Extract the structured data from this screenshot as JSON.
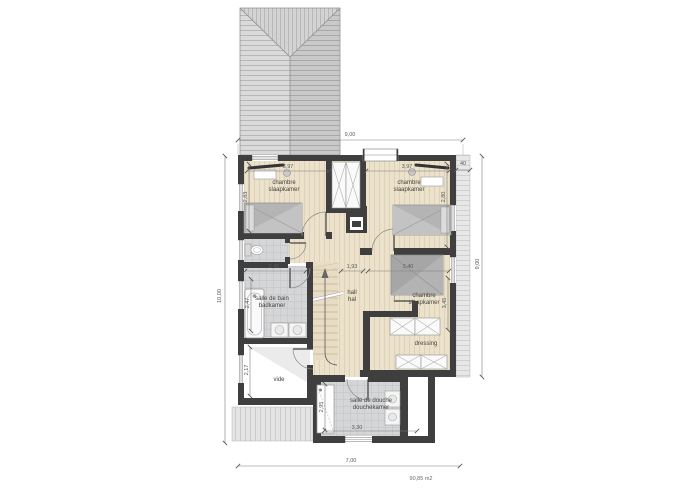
{
  "drawing": {
    "type": "floor-plan",
    "area_label": "90,85 m2"
  },
  "rooms": {
    "bedroom_top_left": {
      "line1": "chambre",
      "line2": "slaapkamer"
    },
    "bedroom_top_right": {
      "line1": "chambre",
      "line2": "slaapkamer"
    },
    "bedroom_right": {
      "line1": "chambre",
      "line2": "slaapkamer"
    },
    "bathroom": {
      "line1": "salle de bain",
      "line2": "badkamer"
    },
    "hall": {
      "line1": "hall",
      "line2": "hal"
    },
    "void": {
      "line1": "vide"
    },
    "dressing": {
      "line1": "dressing"
    },
    "shower_room": {
      "line1": "salle de douche",
      "line2": "douchekamer"
    }
  },
  "dimensions": {
    "overall_top": "9,00",
    "overall_bottom": "7,00",
    "overall_left": "10,00",
    "overall_right": "9,00",
    "eave_offset": "40",
    "bedroom_tl_width": "3,97",
    "bedroom_tl_depth": "2,83",
    "bedroom_tr_width": "3,97",
    "bedroom_tr_depth": "2,80",
    "bathroom_width": "2,45",
    "bathroom_depth": "2,47",
    "hall_width": "1,93",
    "bedroom_r_width": "3,40",
    "bedroom_r_depth": "3,45",
    "void_depth": "2,17",
    "shower_width": "3,30",
    "shower_depth": "2,95"
  },
  "colors": {
    "wall": "#3f3f3f",
    "wood_floor": "#ece2cb",
    "tile_floor": "#d5d6d8",
    "roof": "#d4d4d4",
    "furniture": "#b4b4b4",
    "dimension_line": "#7d7d7d"
  }
}
